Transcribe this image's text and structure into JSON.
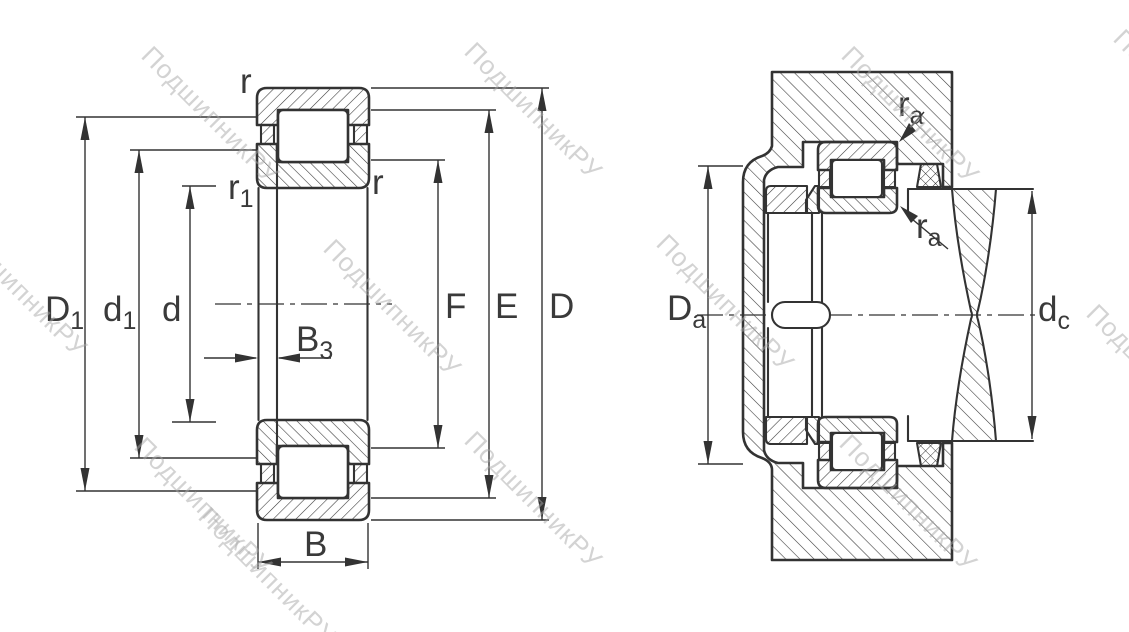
{
  "watermark": {
    "text": "ПодшипникРУ"
  },
  "colors": {
    "line": "#333333",
    "label": "#3a3a3a",
    "watermark": "#a8a8a8",
    "background": "#ffffff"
  },
  "left_view": {
    "labels": {
      "D1": {
        "main": "D",
        "sub": "1"
      },
      "d1": {
        "main": "d",
        "sub": "1"
      },
      "d": {
        "main": "d",
        "sub": ""
      },
      "B3": {
        "main": "B",
        "sub": "3"
      },
      "B": {
        "main": "B",
        "sub": ""
      },
      "F": {
        "main": "F",
        "sub": ""
      },
      "E": {
        "main": "E",
        "sub": ""
      },
      "D": {
        "main": "D",
        "sub": ""
      },
      "r_top": {
        "main": "r",
        "sub": ""
      },
      "r1": {
        "main": "r",
        "sub": "1"
      },
      "r_side": {
        "main": "r",
        "sub": ""
      }
    }
  },
  "right_view": {
    "labels": {
      "Da": {
        "main": "D",
        "sub": "a"
      },
      "dc": {
        "main": "d",
        "sub": "c"
      },
      "ra_top": {
        "main": "r",
        "sub": "a"
      },
      "ra_bottom": {
        "main": "r",
        "sub": "a"
      }
    }
  }
}
